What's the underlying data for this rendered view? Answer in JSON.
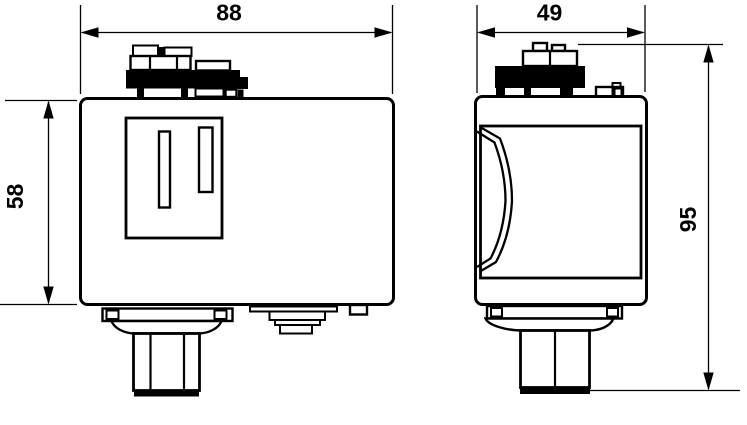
{
  "drawing": {
    "type": "technical-dimension-drawing",
    "colors": {
      "line": "#000000",
      "background": "#ffffff",
      "terminal_block_fill": "#000000"
    },
    "dimensions": {
      "front_width": "88",
      "side_width": "49",
      "front_body_height": "58",
      "total_height": "95"
    }
  }
}
